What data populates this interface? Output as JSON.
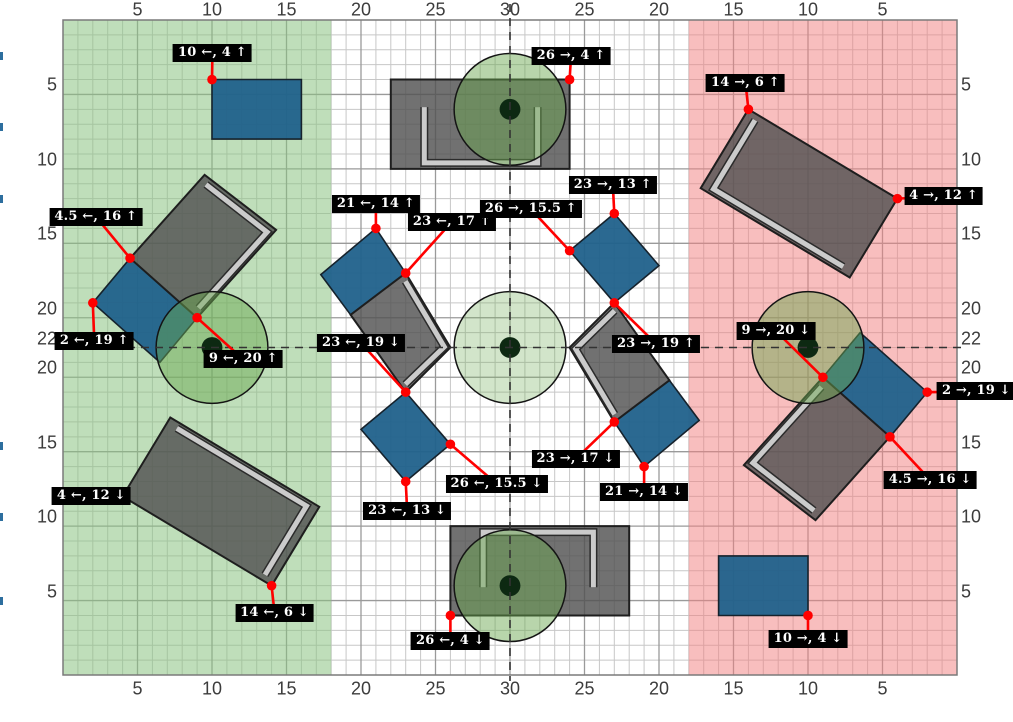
{
  "figure": {
    "width": 1013,
    "height": 722,
    "plot": {
      "left": 63,
      "top": 20,
      "right": 957,
      "bottom": 675,
      "units_x": 60,
      "units_y": 44
    },
    "room_width": 60,
    "room_height": 44
  },
  "colors": {
    "background": "#ffffff",
    "grid_minor": "#c7c7c7",
    "grid_major": "#9a9a9a",
    "plot_border": "#7a7a7a",
    "zone_green": "rgba(139,195,130,0.55)",
    "zone_pink": "rgba(241,130,130,0.52)",
    "table_fill": "rgba(82,82,82,0.82)",
    "table_stroke": "#1e1e1e",
    "band_outline": "#2b2b2b",
    "band_fill": "#cbcbcb",
    "chair_fill": "#20618b",
    "chair_stroke": "#16222c",
    "person_fill": "#6aa84f",
    "person_stroke": "#141414",
    "person_dot": "#0d2912",
    "person_alpha": 0.48,
    "person_alpha_light": 0.3,
    "dashed_line": "#333333",
    "callout_red": "#ff0000",
    "label_bg": "#000000",
    "label_text": "#ffffff",
    "axis_text": "#3c3c3c",
    "edge_mark": "#2d6e9e"
  },
  "axes": {
    "top": {
      "labels": [
        "5",
        "10",
        "15",
        "20",
        "25",
        "30",
        "25",
        "20",
        "15",
        "10",
        "5"
      ],
      "positions": [
        5,
        10,
        15,
        20,
        25,
        30,
        35,
        40,
        45,
        50,
        55
      ]
    },
    "bottom": {
      "labels": [
        "5",
        "10",
        "15",
        "20",
        "25",
        "30",
        "25",
        "20",
        "15",
        "10",
        "5"
      ],
      "positions": [
        5,
        10,
        15,
        20,
        25,
        30,
        35,
        40,
        45,
        50,
        55
      ]
    },
    "left": {
      "labels": [
        "5",
        "10",
        "15",
        "20",
        "22",
        "20",
        "15",
        "10",
        "5"
      ],
      "positions": [
        5,
        10,
        15,
        20,
        22,
        24,
        29,
        34,
        39
      ]
    },
    "right": {
      "labels": [
        "5",
        "10",
        "15",
        "20",
        "22",
        "20",
        "15",
        "10",
        "5"
      ],
      "positions": [
        5,
        10,
        15,
        20,
        22,
        24,
        29,
        34,
        39
      ]
    }
  },
  "grid": {
    "minor_step": 1,
    "major_x": [
      5,
      10,
      15,
      20,
      25,
      30,
      35,
      40,
      45,
      50,
      55
    ],
    "major_y": [
      5,
      10,
      15,
      20,
      24,
      29,
      34,
      39
    ]
  },
  "zones": [
    {
      "id": "green-zone",
      "x0": 0,
      "x1": 18,
      "fill_key": "zone_green"
    },
    {
      "id": "pink-zone",
      "x0": 42,
      "x1": 60,
      "fill_key": "zone_pink"
    }
  ],
  "center_lines": {
    "vertical_x": 30,
    "horizontal_y": 22
  },
  "tables": [
    {
      "id": "top-table",
      "points": [
        [
          22,
          4
        ],
        [
          34,
          4
        ],
        [
          34,
          10
        ],
        [
          22,
          10
        ]
      ],
      "band": [
        [
          24.25,
          5.85
        ],
        [
          24.25,
          9.6
        ],
        [
          31.85,
          9.6
        ],
        [
          31.85,
          5.85
        ]
      ]
    },
    {
      "id": "bottom-table",
      "points": [
        [
          26,
          34
        ],
        [
          38,
          34
        ],
        [
          38,
          40
        ],
        [
          26,
          40
        ]
      ],
      "band": [
        [
          35.6,
          38.1
        ],
        [
          35.6,
          34.4
        ],
        [
          28.2,
          34.4
        ],
        [
          28.2,
          38.1
        ]
      ]
    },
    {
      "id": "west-table",
      "points": [
        [
          4.5,
          16
        ],
        [
          9.5,
          10.4
        ],
        [
          14.3,
          14.1
        ],
        [
          9,
          20
        ]
      ],
      "band": [
        [
          9.6,
          11.05
        ],
        [
          13.7,
          14.25
        ],
        [
          9.1,
          19.35
        ]
      ]
    },
    {
      "id": "east-table",
      "points": [
        [
          55.5,
          28
        ],
        [
          50.5,
          33.6
        ],
        [
          45.7,
          29.9
        ],
        [
          51,
          24
        ]
      ],
      "band": [
        [
          50.4,
          32.95
        ],
        [
          46.3,
          29.75
        ],
        [
          50.9,
          24.65
        ]
      ]
    },
    {
      "id": "center-left-table",
      "points": [
        [
          23,
          17
        ],
        [
          26,
          22
        ],
        [
          23,
          25
        ],
        [
          19.3,
          19.8
        ]
      ],
      "band": [
        [
          22.98,
          17.55
        ],
        [
          25.59,
          21.95
        ],
        [
          22.98,
          24.47
        ]
      ]
    },
    {
      "id": "center-right-table",
      "points": [
        [
          37,
          19
        ],
        [
          34,
          22
        ],
        [
          37,
          27
        ],
        [
          40.7,
          24.2
        ]
      ],
      "band": [
        [
          37.02,
          19.53
        ],
        [
          34.41,
          22.1
        ],
        [
          37.02,
          26.49
        ]
      ]
    },
    {
      "id": "northeast-corner-table",
      "points": [
        [
          46,
          6
        ],
        [
          56,
          12
        ],
        [
          52.8,
          17.3
        ],
        [
          42.8,
          11.3
        ]
      ],
      "band": [
        [
          46.44,
          6.73
        ],
        [
          43.66,
          11.35
        ],
        [
          52.36,
          16.57
        ]
      ]
    },
    {
      "id": "southwest-corner-table",
      "points": [
        [
          14,
          38
        ],
        [
          4,
          32
        ],
        [
          7.2,
          26.7
        ],
        [
          17.2,
          32.7
        ]
      ],
      "band": [
        [
          13.56,
          37.27
        ],
        [
          16.34,
          32.65
        ],
        [
          7.64,
          27.43
        ]
      ]
    }
  ],
  "chairs": [
    {
      "id": "top-left-chair",
      "points": [
        [
          10,
          4
        ],
        [
          16,
          4
        ],
        [
          16,
          8
        ],
        [
          10,
          8
        ]
      ]
    },
    {
      "id": "bottom-right-chair",
      "points": [
        [
          44,
          36
        ],
        [
          50,
          36
        ],
        [
          50,
          40
        ],
        [
          44,
          40
        ]
      ]
    },
    {
      "id": "west-chair",
      "points": [
        [
          2,
          19
        ],
        [
          4.5,
          16
        ],
        [
          9,
          20
        ],
        [
          6.5,
          23
        ]
      ]
    },
    {
      "id": "east-chair",
      "points": [
        [
          58,
          25
        ],
        [
          55.5,
          28
        ],
        [
          51,
          24
        ],
        [
          53.5,
          21
        ]
      ]
    },
    {
      "id": "northwest-chair",
      "points": [
        [
          21,
          14
        ],
        [
          23,
          17
        ],
        [
          19.3,
          19.8
        ],
        [
          17.3,
          17.1
        ]
      ]
    },
    {
      "id": "northeast-chair",
      "points": [
        [
          37,
          13
        ],
        [
          40,
          16.5
        ],
        [
          37,
          19
        ],
        [
          34,
          15.5
        ]
      ]
    },
    {
      "id": "southwest-chair",
      "points": [
        [
          23,
          31
        ],
        [
          20,
          27.5
        ],
        [
          23,
          25
        ],
        [
          26,
          28.5
        ]
      ]
    },
    {
      "id": "southeast-chair",
      "points": [
        [
          39,
          30
        ],
        [
          37,
          27
        ],
        [
          40.7,
          24.2
        ],
        [
          42.7,
          26.9
        ]
      ]
    }
  ],
  "persons": [
    {
      "id": "west-person",
      "cx": 10,
      "cy": 22,
      "light": false
    },
    {
      "id": "east-person",
      "cx": 50,
      "cy": 22,
      "light": false
    },
    {
      "id": "top-person",
      "cx": 30,
      "cy": 6,
      "light": false
    },
    {
      "id": "bottom-person",
      "cx": 30,
      "cy": 38,
      "light": false
    },
    {
      "id": "center-person",
      "cx": 30,
      "cy": 22,
      "light": true
    }
  ],
  "person_radius": 3.75,
  "person_dot_radius": 0.7,
  "callouts": [
    {
      "label": "10 ←, 4 ↑",
      "ax": 10,
      "ay": 4,
      "bx": 10.03,
      "by": 2.25
    },
    {
      "label": "26 →, 4 ↑",
      "ax": 34,
      "ay": 4,
      "bx": 34.1,
      "by": 2.4
    },
    {
      "label": "14 →, 6 ↑",
      "ax": 46,
      "ay": 6,
      "bx": 45.8,
      "by": 4.2
    },
    {
      "label": "4 →, 12 ↑",
      "ax": 56,
      "ay": 12,
      "bx": 59.1,
      "by": 11.85
    },
    {
      "label": "4.5 ←, 16 ↑",
      "ax": 4.5,
      "ay": 16,
      "bx": 2.2,
      "by": 13.2
    },
    {
      "label": "21 ←, 14 ↑",
      "ax": 21,
      "ay": 14,
      "bx": 21,
      "by": 12.35
    },
    {
      "label": "23 ←, 17 ↑",
      "ax": 23,
      "ay": 17,
      "bx": 26.1,
      "by": 13.55
    },
    {
      "label": "26 →, 15.5 ↑",
      "ax": 34,
      "ay": 15.5,
      "bx": 31.4,
      "by": 12.7
    },
    {
      "label": "23 →, 13 ↑",
      "ax": 37,
      "ay": 13,
      "bx": 36.9,
      "by": 11.1
    },
    {
      "label": "2 ←, 19 ↑",
      "ax": 2,
      "ay": 19,
      "bx": 2.1,
      "by": 21.55
    },
    {
      "label": "9 ←, 20 ↑",
      "ax": 9,
      "ay": 20,
      "bx": 12.1,
      "by": 22.8
    },
    {
      "label": "23 ←, 19 ↓",
      "ax": 23,
      "ay": 25,
      "bx": 20,
      "by": 21.7
    },
    {
      "label": "23 →, 19 ↑",
      "ax": 37,
      "ay": 19,
      "bx": 39.8,
      "by": 21.75
    },
    {
      "label": "9 →, 20 ↓",
      "ax": 51,
      "ay": 24,
      "bx": 47.85,
      "by": 20.9
    },
    {
      "label": "2 →, 19 ↓",
      "ax": 58,
      "ay": 25,
      "bx": 61.3,
      "by": 24.95
    },
    {
      "label": "4 ←, 12 ↓",
      "ax": 4,
      "ay": 32,
      "bx": 1.9,
      "by": 31.95
    },
    {
      "label": "23 ←, 13 ↓",
      "ax": 23,
      "ay": 31,
      "bx": 23.1,
      "by": 32.95
    },
    {
      "label": "26 ←, 15.5 ↓",
      "ax": 26,
      "ay": 28.5,
      "bx": 29.1,
      "by": 31.15
    },
    {
      "label": "23 →, 17 ↓",
      "ax": 37,
      "ay": 27,
      "bx": 34.4,
      "by": 29.5
    },
    {
      "label": "21 →, 14 ↓",
      "ax": 39,
      "ay": 30,
      "bx": 39,
      "by": 31.7
    },
    {
      "label": "4.5 →, 16 ↓",
      "ax": 55.5,
      "ay": 28,
      "bx": 58.2,
      "by": 30.9
    },
    {
      "label": "14 ←, 6 ↓",
      "ax": 14,
      "ay": 38,
      "bx": 14.2,
      "by": 39.85
    },
    {
      "label": "26 ←, 4 ↓",
      "ax": 26,
      "ay": 40,
      "bx": 26,
      "by": 41.7
    },
    {
      "label": "10 →, 4 ↓",
      "ax": 50,
      "ay": 40,
      "bx": 50,
      "by": 41.6
    }
  ],
  "edge_marks": {
    "x": 0,
    "width": 3,
    "height": 8,
    "y_positions": [
      52,
      123,
      195,
      442,
      513,
      597
    ]
  }
}
